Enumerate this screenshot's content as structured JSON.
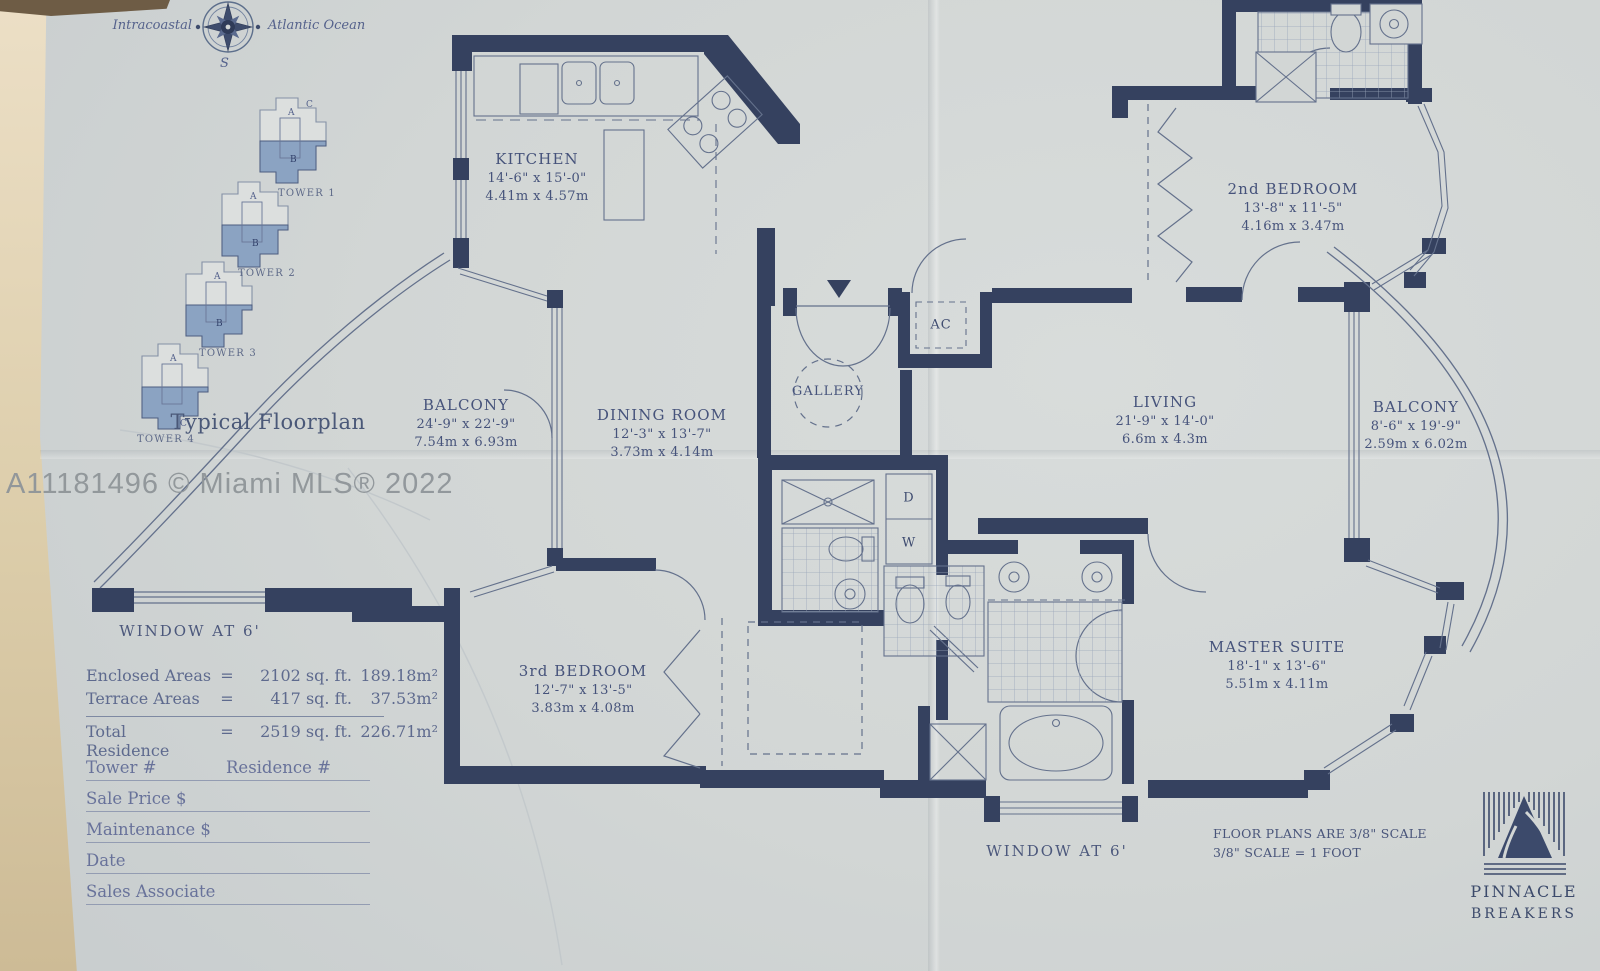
{
  "photo": {
    "watermark": "A11181496 © Miami MLS® 2022"
  },
  "sidebar": {
    "compass": {
      "west": "Intracoastal",
      "east": "Atlantic Ocean",
      "south": "S"
    },
    "unit_letters": {
      "a": "A",
      "b": "B",
      "c": "C"
    },
    "towers": [
      {
        "label": "TOWER 1"
      },
      {
        "label": "TOWER 2"
      },
      {
        "label": "TOWER 3"
      },
      {
        "label": "TOWER 4"
      }
    ],
    "title": "Typical Floorplan",
    "window_note": "WINDOW AT 6'",
    "areas": {
      "rows": [
        {
          "label": "Enclosed Areas",
          "eq": "=",
          "sqft": "2102 sq. ft.",
          "sqm": "189.18m²"
        },
        {
          "label": "Terrace Areas",
          "eq": "=",
          "sqft": "417 sq. ft.",
          "sqm": "37.53m²"
        },
        {
          "label": "Total Residence",
          "eq": "=",
          "sqft": "2519 sq. ft.",
          "sqm": "226.71m²"
        }
      ]
    },
    "form": {
      "tower": "Tower #",
      "residence": "Residence #",
      "sale_price": "Sale Price $",
      "maintenance": "Maintenance $",
      "date": "Date",
      "sales_associate": "Sales Associate"
    }
  },
  "plan": {
    "rooms": {
      "kitchen": {
        "name": "KITCHEN",
        "ft": "14'-6\" x 15'-0\"",
        "m": "4.41m x 4.57m"
      },
      "balcony_left": {
        "name": "BALCONY",
        "ft": "24'-9\" x 22'-9\"",
        "m": "7.54m x 6.93m"
      },
      "dining": {
        "name": "DINING ROOM",
        "ft": "12'-3\" x 13'-7\"",
        "m": "3.73m x 4.14m"
      },
      "gallery": {
        "name": "GALLERY"
      },
      "living": {
        "name": "LIVING",
        "ft": "21'-9\" x 14'-0\"",
        "m": "6.6m x 4.3m"
      },
      "bed2": {
        "name": "2nd BEDROOM",
        "ft": "13'-8\" x 11'-5\"",
        "m": "4.16m x 3.47m"
      },
      "balcony_right": {
        "name": "BALCONY",
        "ft": "8'-6\" x 19'-9\"",
        "m": "2.59m x 6.02m"
      },
      "bed3": {
        "name": "3rd BEDROOM",
        "ft": "12'-7\" x 13'-5\"",
        "m": "3.83m x 4.08m"
      },
      "master": {
        "name": "MASTER SUITE",
        "ft": "18'-1\" x 13'-6\"",
        "m": "5.51m x 4.11m"
      }
    },
    "labels": {
      "ac": "AC",
      "d": "D",
      "w": "W"
    },
    "window_note": "WINDOW AT 6'",
    "scale_note": {
      "line1": "FLOOR PLANS ARE 3/8\" SCALE",
      "line2": "3/8\" SCALE = 1 FOOT"
    }
  },
  "brand": {
    "name": "PINNACLE",
    "sub": "BREAKERS"
  },
  "colors": {
    "wall": "#35415f",
    "thin_line": "#64718c",
    "shaded_unit": "#8ba3c2",
    "paper": "#d2d6d5",
    "text": "#46537b"
  }
}
